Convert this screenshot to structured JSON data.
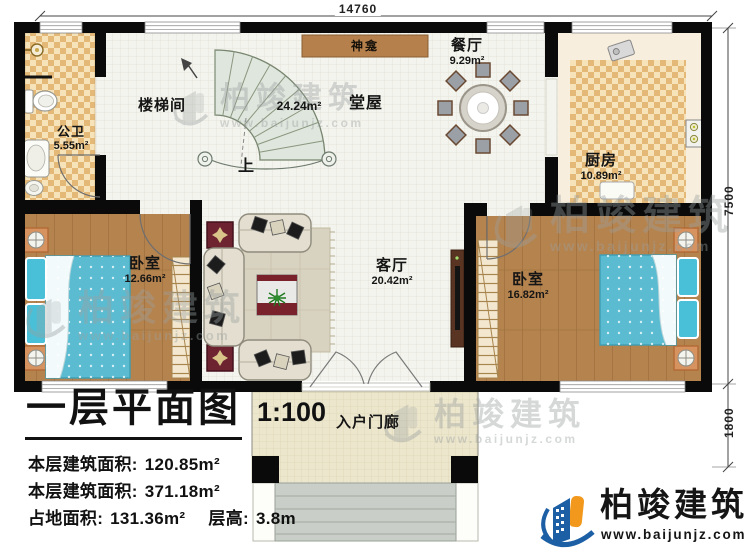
{
  "dimensions": {
    "top": "14760",
    "right_upper": "7500",
    "right_lower": "1800"
  },
  "rooms": {
    "bathroom": {
      "name": "公卫",
      "area": "5.55m²"
    },
    "stairwell": {
      "name": "楼梯间"
    },
    "hall": {
      "name": "堂屋",
      "area": "24.24m²"
    },
    "shrine": {
      "name": "神龛"
    },
    "dining": {
      "name": "餐厅",
      "area": "9.29m²"
    },
    "kitchen": {
      "name": "厨房",
      "area": "10.89m²"
    },
    "bedroom_left": {
      "name": "卧室",
      "area": "12.66m²"
    },
    "living": {
      "name": "客厅",
      "area": "20.42m²"
    },
    "bedroom_right": {
      "name": "卧室",
      "area": "16.82m²"
    },
    "porch": {
      "name": "入户门廊"
    }
  },
  "stair": {
    "up_label": "上"
  },
  "title_block": {
    "title": "一层平面图",
    "scale": "1:100",
    "stats": [
      {
        "label": "本层建筑面积:",
        "value": "120.85m²"
      },
      {
        "label": "本层建筑面积:",
        "value": "371.18m²"
      },
      {
        "label": "占地面积:",
        "value": "131.36m²"
      },
      {
        "label": "层高:",
        "value": "3.8m"
      }
    ]
  },
  "brand": {
    "name": "柏竣建筑",
    "website": "www.baijunjz.com"
  },
  "colors": {
    "wall": "#0a0a0a",
    "wood_floor": "#b5834e",
    "tile_dark": "#e4b877",
    "tile_light": "#f6e3ba",
    "mattress_blue": "#5bbcd1",
    "shrine_brown": "#b5804c",
    "stair_green": "#dfe6dd",
    "maroon": "#6e2331",
    "logo_blue": "#1c5fa5",
    "logo_orange": "#f2991d"
  }
}
